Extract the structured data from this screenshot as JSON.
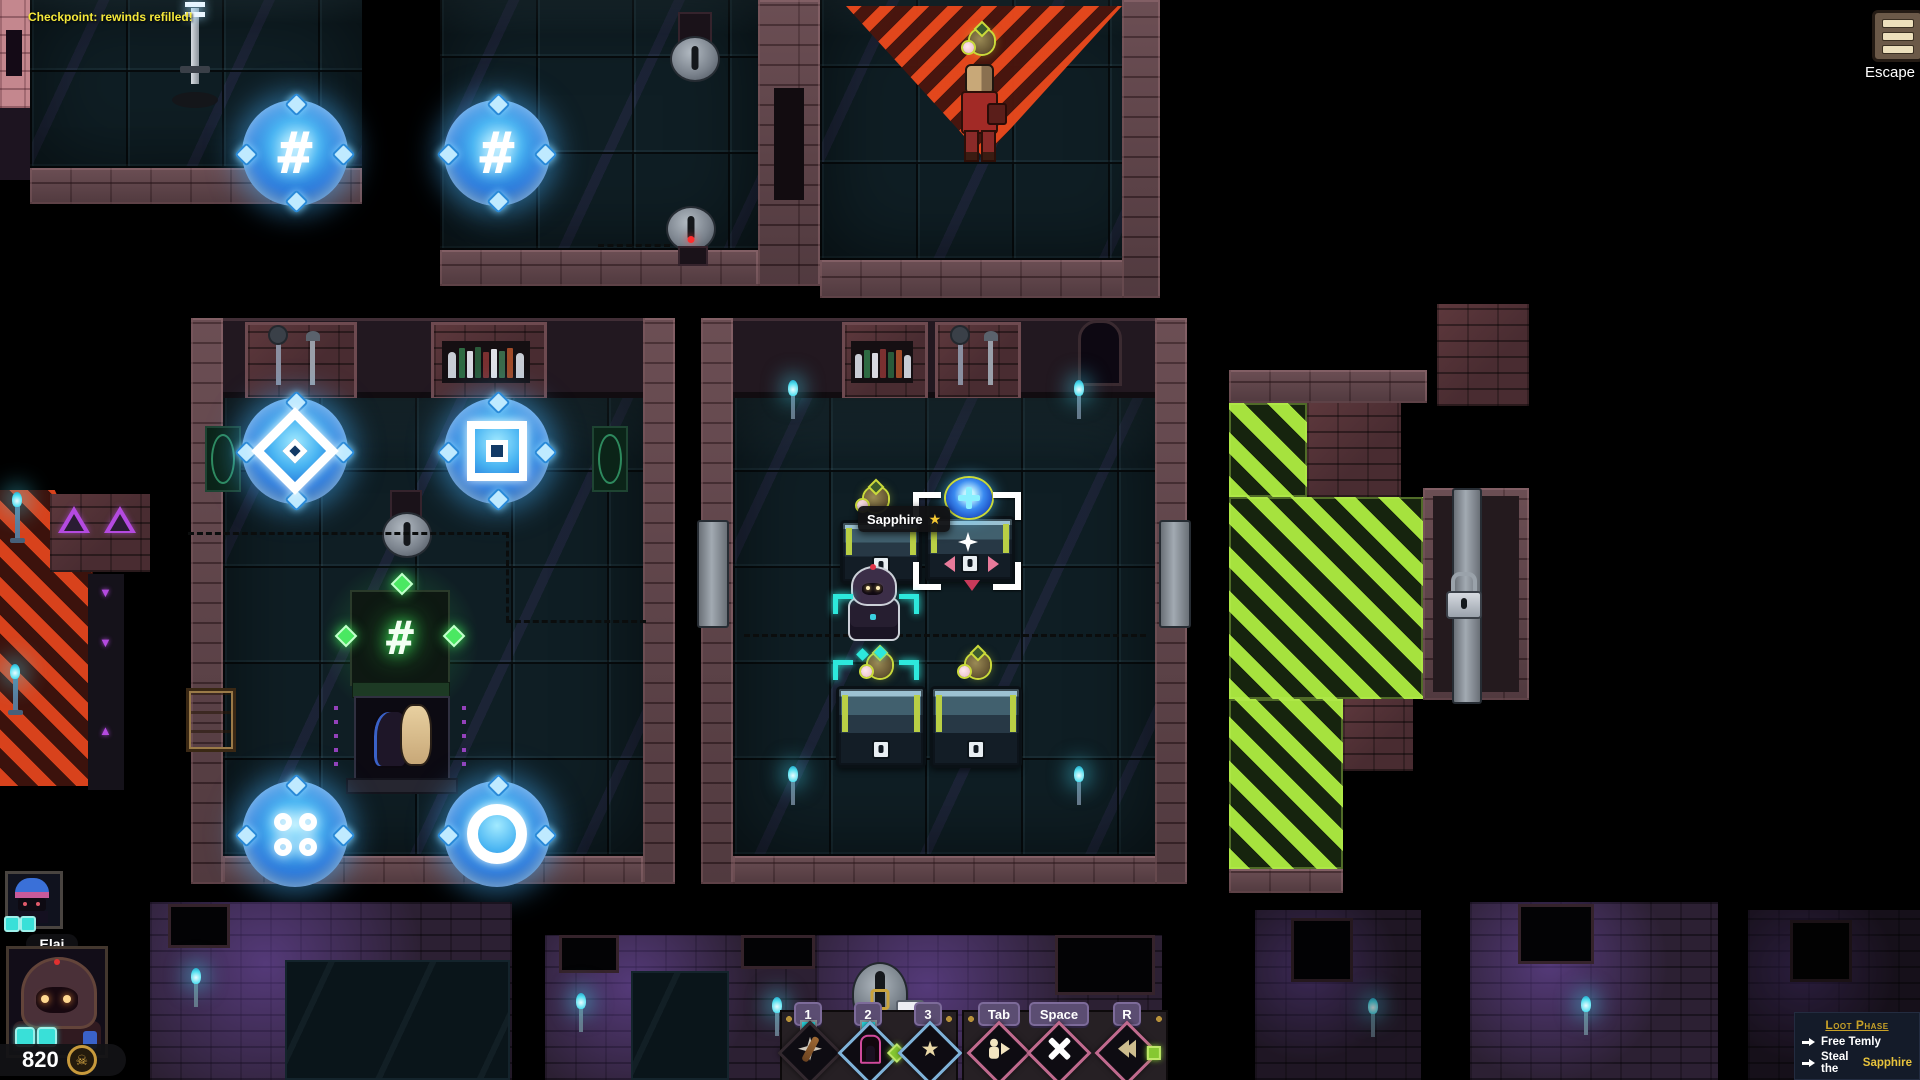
{
  "hud": {
    "checkpoint_message": "Checkpoint: rewinds refilled!",
    "escape_label": "Escape",
    "tooltip": {
      "item_name": "Sapphire",
      "star": "★"
    },
    "party": {
      "leader_name": "Elaj",
      "coins": "820",
      "coin_icon": "☠"
    },
    "hotbar": {
      "key1": "1",
      "key2": "2",
      "key3": "3",
      "key_tab": "Tab",
      "key_space": "Space",
      "key_r": "R",
      "slot3_star": "★"
    },
    "objectives": {
      "title": "Loot Phase",
      "obj1": "Free Temly",
      "obj2_pre": "Steal the",
      "obj2_target": "Sapphire"
    }
  },
  "map": {
    "portal_glyph_hash": "#",
    "containment_glyph": "#",
    "rune_down": "▼",
    "rune_up": "▲"
  },
  "colors": {
    "accent_gold": "#d4a92c",
    "portal_blue": "#3fa9f5",
    "alarm_red": "#e8481c",
    "exit_green": "#a6e23e",
    "marker_cyan": "#2de8dc"
  }
}
